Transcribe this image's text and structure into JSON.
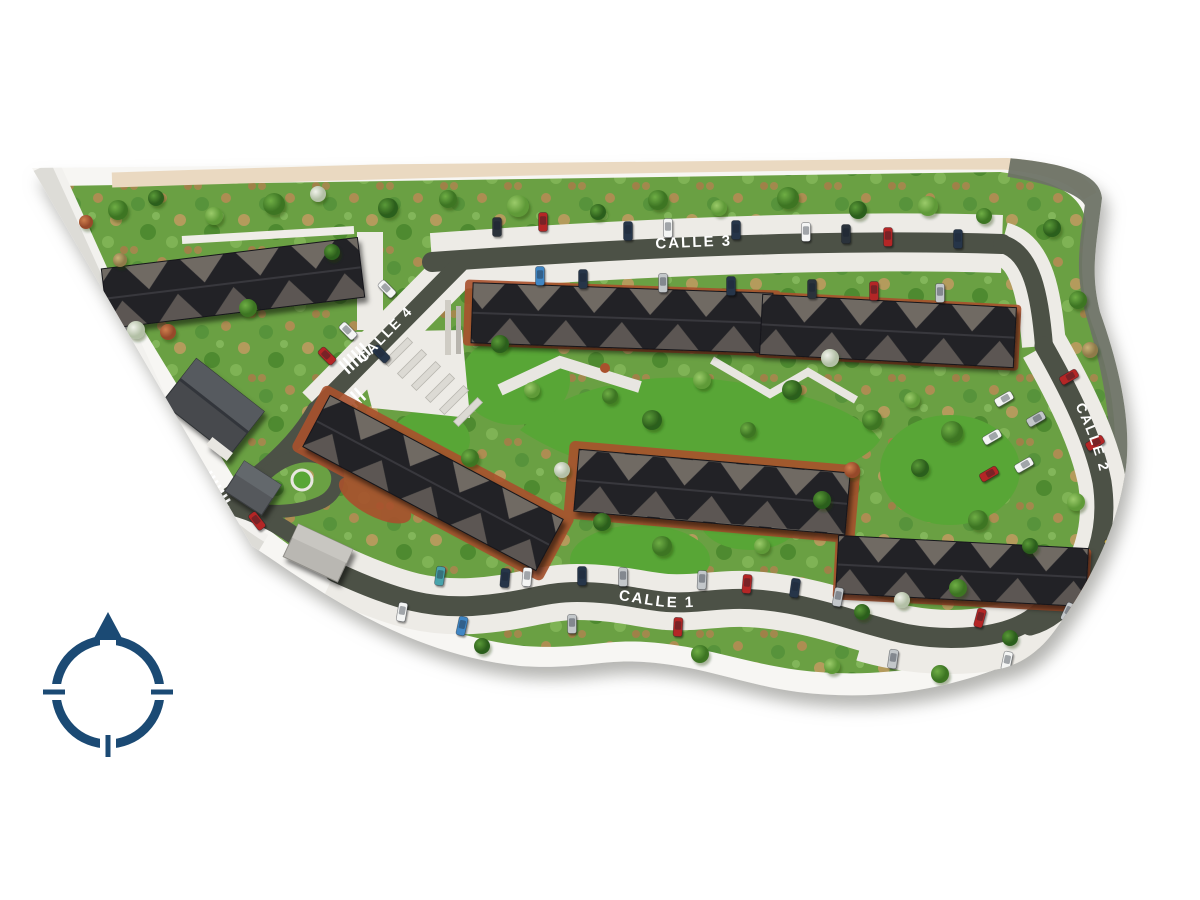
{
  "image_type": "residential-masterplan-site-rendering-top-view",
  "streets": {
    "avenida": "AVENIDA CENTENARIO",
    "calle1": "CALLE 1",
    "calle2": "CALLE 2",
    "calle3": "CALLE 3",
    "calle4": "CALLE 4"
  },
  "compass": {
    "orientation": "north-up"
  },
  "colors": {
    "background": "#ffffff",
    "asphalt": "#4c5146",
    "parking_apron": "#edebe6",
    "vegetation_green": "#6aa043",
    "lawn_green": "#58a636",
    "roof_dark": "#232227",
    "roof_facet": "#6f6a64",
    "terracotta": "#aa5330",
    "tan_strip": "#ead9c1",
    "perimeter_band": "#6e7366",
    "compass_navy": "#1b4a74"
  },
  "car_palette": {
    "wh": "#f4f5f4",
    "sl": "#c3c7ca",
    "dk": "#2b323b",
    "nv": "#25354a",
    "rd": "#b42525",
    "bl": "#3f86c4",
    "yl": "#d9b93f",
    "tl": "#49a3ab"
  },
  "cars": [
    [
      497,
      227,
      0,
      "dk"
    ],
    [
      543,
      222,
      0,
      "rd"
    ],
    [
      628,
      231,
      0,
      "nv"
    ],
    [
      668,
      228,
      0,
      "wh"
    ],
    [
      736,
      230,
      0,
      "nv"
    ],
    [
      806,
      232,
      0,
      "wh"
    ],
    [
      846,
      234,
      0,
      "dk"
    ],
    [
      888,
      237,
      0,
      "rd"
    ],
    [
      958,
      239,
      0,
      "nv"
    ],
    [
      540,
      276,
      0,
      "bl"
    ],
    [
      583,
      279,
      0,
      "nv"
    ],
    [
      663,
      283,
      0,
      "sl"
    ],
    [
      731,
      286,
      0,
      "nv"
    ],
    [
      812,
      289,
      0,
      "dk"
    ],
    [
      874,
      291,
      0,
      "rd"
    ],
    [
      940,
      293,
      0,
      "sl"
    ],
    [
      387,
      289,
      -45,
      "wh"
    ],
    [
      348,
      331,
      -45,
      "wh"
    ],
    [
      381,
      354,
      -45,
      "nv"
    ],
    [
      327,
      356,
      -45,
      "rd"
    ],
    [
      257,
      521,
      -38,
      "rd"
    ],
    [
      298,
      589,
      -25,
      "dk"
    ],
    [
      440,
      576,
      8,
      "tl"
    ],
    [
      505,
      578,
      5,
      "nv"
    ],
    [
      527,
      577,
      5,
      "wh"
    ],
    [
      582,
      576,
      0,
      "nv"
    ],
    [
      623,
      577,
      0,
      "sl"
    ],
    [
      702,
      580,
      3,
      "sl"
    ],
    [
      747,
      584,
      5,
      "rd"
    ],
    [
      795,
      588,
      8,
      "nv"
    ],
    [
      838,
      597,
      10,
      "sl"
    ],
    [
      402,
      612,
      10,
      "wh"
    ],
    [
      462,
      626,
      12,
      "bl"
    ],
    [
      572,
      624,
      0,
      "sl"
    ],
    [
      678,
      627,
      3,
      "rd"
    ],
    [
      893,
      659,
      8,
      "sl"
    ],
    [
      1007,
      661,
      12,
      "wh"
    ],
    [
      980,
      618,
      15,
      "rd"
    ],
    [
      1068,
      612,
      25,
      "sl"
    ],
    [
      1004,
      399,
      60,
      "wh"
    ],
    [
      1036,
      419,
      60,
      "sl"
    ],
    [
      992,
      437,
      60,
      "wh"
    ],
    [
      1024,
      465,
      60,
      "wh"
    ],
    [
      989,
      474,
      60,
      "rd"
    ],
    [
      1069,
      377,
      60,
      "rd"
    ],
    [
      1095,
      443,
      60,
      "rd"
    ],
    [
      1114,
      540,
      58,
      "yl"
    ]
  ],
  "trees": [
    [
      118,
      210,
      10,
      "m"
    ],
    [
      156,
      198,
      8,
      "d"
    ],
    [
      214,
      216,
      9,
      "l"
    ],
    [
      274,
      204,
      11,
      "m"
    ],
    [
      318,
      194,
      8,
      "w"
    ],
    [
      388,
      208,
      10,
      "d"
    ],
    [
      448,
      199,
      9,
      "m"
    ],
    [
      518,
      206,
      11,
      "l"
    ],
    [
      598,
      212,
      8,
      "d"
    ],
    [
      658,
      200,
      10,
      "m"
    ],
    [
      719,
      208,
      8,
      "l"
    ],
    [
      788,
      198,
      11,
      "m"
    ],
    [
      858,
      210,
      9,
      "d"
    ],
    [
      928,
      206,
      10,
      "l"
    ],
    [
      984,
      216,
      8,
      "m"
    ],
    [
      1052,
      228,
      9,
      "d"
    ],
    [
      1078,
      300,
      9,
      "m"
    ],
    [
      1090,
      350,
      8,
      "o"
    ],
    [
      68,
      252,
      9,
      "m"
    ],
    [
      94,
      300,
      8,
      "d"
    ],
    [
      118,
      348,
      9,
      "l"
    ],
    [
      104,
      388,
      7,
      "w"
    ],
    [
      142,
      420,
      9,
      "m"
    ],
    [
      168,
      332,
      8,
      "t"
    ],
    [
      136,
      330,
      9,
      "w"
    ],
    [
      248,
      308,
      9,
      "m"
    ],
    [
      332,
      252,
      8,
      "d"
    ],
    [
      500,
      344,
      9,
      "d"
    ],
    [
      532,
      390,
      8,
      "l"
    ],
    [
      610,
      396,
      8,
      "m"
    ],
    [
      652,
      420,
      10,
      "d"
    ],
    [
      702,
      380,
      9,
      "l"
    ],
    [
      748,
      430,
      8,
      "m"
    ],
    [
      792,
      390,
      10,
      "d"
    ],
    [
      830,
      358,
      9,
      "w"
    ],
    [
      872,
      420,
      10,
      "m"
    ],
    [
      912,
      400,
      8,
      "l"
    ],
    [
      952,
      432,
      11,
      "m"
    ],
    [
      920,
      468,
      9,
      "d"
    ],
    [
      470,
      458,
      9,
      "m"
    ],
    [
      562,
      470,
      8,
      "w"
    ],
    [
      602,
      522,
      9,
      "d"
    ],
    [
      662,
      546,
      10,
      "m"
    ],
    [
      762,
      546,
      8,
      "l"
    ],
    [
      822,
      500,
      9,
      "d"
    ],
    [
      852,
      470,
      8,
      "t"
    ],
    [
      978,
      520,
      10,
      "m"
    ],
    [
      1030,
      546,
      8,
      "d"
    ],
    [
      1076,
      502,
      9,
      "l"
    ],
    [
      902,
      600,
      8,
      "w"
    ],
    [
      958,
      588,
      9,
      "m"
    ],
    [
      862,
      612,
      8,
      "d"
    ],
    [
      352,
      628,
      9,
      "m"
    ],
    [
      482,
      646,
      8,
      "d"
    ],
    [
      700,
      654,
      9,
      "m"
    ],
    [
      832,
      666,
      8,
      "l"
    ],
    [
      940,
      674,
      9,
      "m"
    ],
    [
      1010,
      638,
      8,
      "d"
    ],
    [
      158,
      452,
      9,
      "m"
    ],
    [
      196,
      478,
      8,
      "d"
    ],
    [
      288,
      592,
      9,
      "l"
    ],
    [
      120,
      260,
      7,
      "o"
    ],
    [
      86,
      222,
      7,
      "t"
    ]
  ]
}
